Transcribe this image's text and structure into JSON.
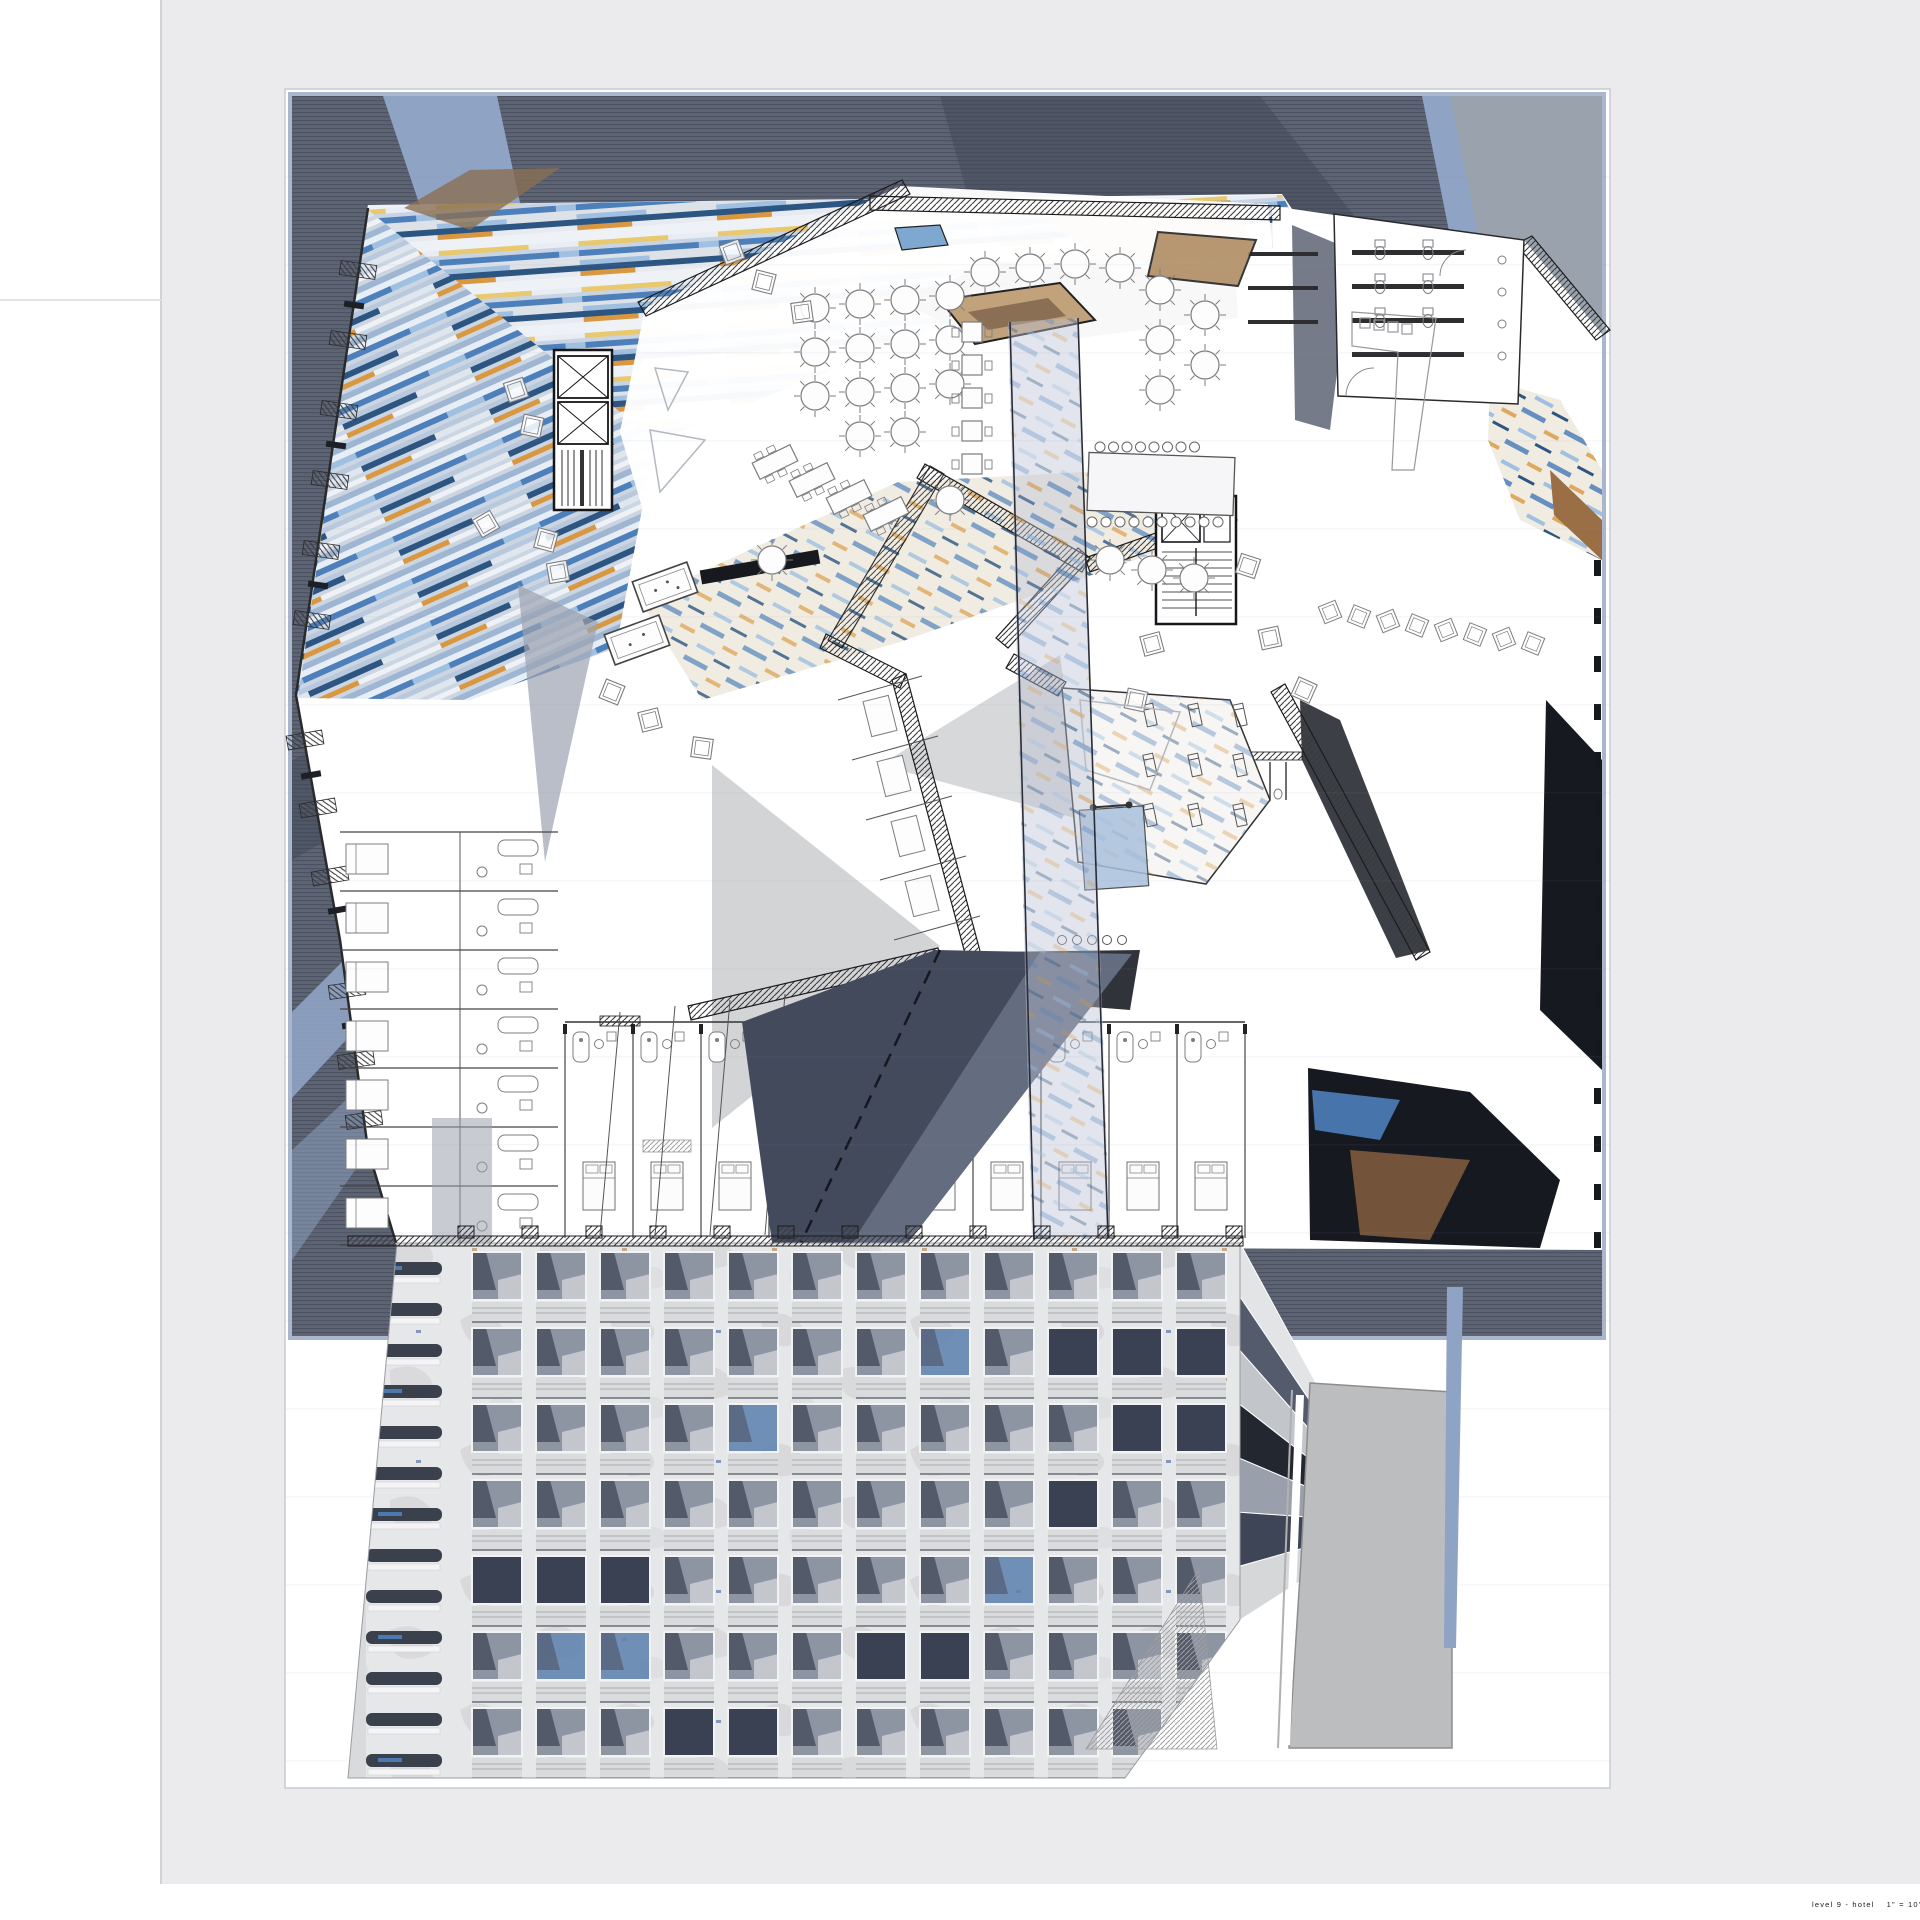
{
  "document": {
    "kind": "architectural floor plan presentation sheet",
    "caption": {
      "title": "level 9 - hotel",
      "scale": "1\" = 10' - 0\""
    }
  },
  "palette": {
    "mat": "#ebebed",
    "sheet": "#ffffff",
    "sheet_edge": "#a9b6cc",
    "site_dark": "#5d6474",
    "site_stripe": "#2b3140",
    "site_shadow": "#3f4656",
    "road": "#8fa3c4",
    "road_gray": "#9aa3ad",
    "mural_base": "#dde2e9",
    "mural_yellow": "#e8c96f",
    "mural_blue": "#4d7fba",
    "mural_blue_dark": "#2c5581",
    "mural_blue_light": "#9fc0e0",
    "mural_orange": "#d9973f",
    "mural_black": "#16191f",
    "mural_tan": "#c6a988",
    "mural_cream": "#f1ece2",
    "wall": "#1c1c1e",
    "furniture": "#7d7d80",
    "shadow_navy": "#434a5c",
    "shadow_navy_light": "#7c8396",
    "triangle_gray": "#d3d4d6",
    "facade_pier": "#e6e7e9",
    "facade_glass": "#8d94a2",
    "facade_glass_dark": "#4c5364",
    "facade_glass_light": "#c9ccd2",
    "facade_spandrel": "#dadbdd",
    "facade_navy": "#3a4153",
    "facade_blue": "#5b7fae",
    "slot_dark": "#3a404c",
    "ghost_gray": "#bcbdbf",
    "skylight_tan": "#c2a27a",
    "skylight_brown": "#8a6f55",
    "caption_color": "#1b1b1b"
  },
  "facade": {
    "columns": 12,
    "floors": 7,
    "slot_windows": 13,
    "navy_cells": [
      [
        9,
        1
      ],
      [
        10,
        1
      ],
      [
        11,
        1
      ],
      [
        10,
        2
      ],
      [
        11,
        2
      ],
      [
        9,
        3
      ],
      [
        0,
        4
      ],
      [
        1,
        4
      ],
      [
        2,
        4
      ],
      [
        6,
        5
      ],
      [
        7,
        5
      ],
      [
        3,
        6
      ],
      [
        4,
        6
      ]
    ],
    "blue_cells": [
      [
        4,
        2
      ],
      [
        7,
        1
      ],
      [
        1,
        5
      ],
      [
        2,
        5
      ],
      [
        8,
        4
      ]
    ],
    "side_bands": [
      "#e3e4e6",
      "#545b6c",
      "#c2c5ca",
      "#23272f",
      "#9aa0ab",
      "#3e4556",
      "#d5d7d9"
    ]
  },
  "plan": {
    "round_tables": [
      [
        815,
        308
      ],
      [
        860,
        304
      ],
      [
        905,
        300
      ],
      [
        950,
        296
      ],
      [
        815,
        352
      ],
      [
        860,
        348
      ],
      [
        905,
        344
      ],
      [
        950,
        340
      ],
      [
        815,
        396
      ],
      [
        860,
        392
      ],
      [
        905,
        388
      ],
      [
        950,
        384
      ],
      [
        860,
        436
      ],
      [
        905,
        432
      ],
      [
        985,
        272
      ],
      [
        1030,
        268
      ],
      [
        1075,
        264
      ],
      [
        1120,
        268
      ],
      [
        1160,
        290
      ],
      [
        1160,
        340
      ],
      [
        1160,
        390
      ],
      [
        1205,
        315
      ],
      [
        1205,
        365
      ],
      [
        1110,
        560
      ],
      [
        1152,
        570
      ],
      [
        1194,
        578
      ],
      [
        950,
        500
      ],
      [
        772,
        560
      ]
    ],
    "banquet_tables": [
      [
        775,
        462
      ],
      [
        812,
        480
      ],
      [
        849,
        497
      ],
      [
        886,
        514
      ]
    ],
    "square_tables_count": 5,
    "bar": {
      "stools_top": 8,
      "stools_bottom": 10
    },
    "lounge_chairs": [
      [
        516,
        390,
        -18
      ],
      [
        532,
        426,
        12
      ],
      [
        486,
        524,
        -30
      ],
      [
        546,
        540,
        15
      ],
      [
        558,
        572,
        -10
      ],
      [
        612,
        692,
        22
      ],
      [
        650,
        720,
        -14
      ],
      [
        702,
        748,
        8
      ],
      [
        732,
        252,
        -20
      ],
      [
        764,
        282,
        14
      ],
      [
        802,
        312,
        -8
      ],
      [
        1248,
        566,
        18
      ],
      [
        1270,
        638,
        -12
      ],
      [
        1304,
        690,
        24
      ],
      [
        1152,
        644,
        -15
      ],
      [
        1136,
        700,
        12
      ]
    ],
    "right_band_chairs": 8,
    "east_window_dashes": 15,
    "left_wing_rooms": 7,
    "bottom_wing_rooms": 10,
    "urinals": 6,
    "toilet_pairs": 3,
    "sinks": 4,
    "gym": {
      "treadmill_rows": 3,
      "treadmill_cols": 3,
      "floor_circles": 5
    }
  }
}
